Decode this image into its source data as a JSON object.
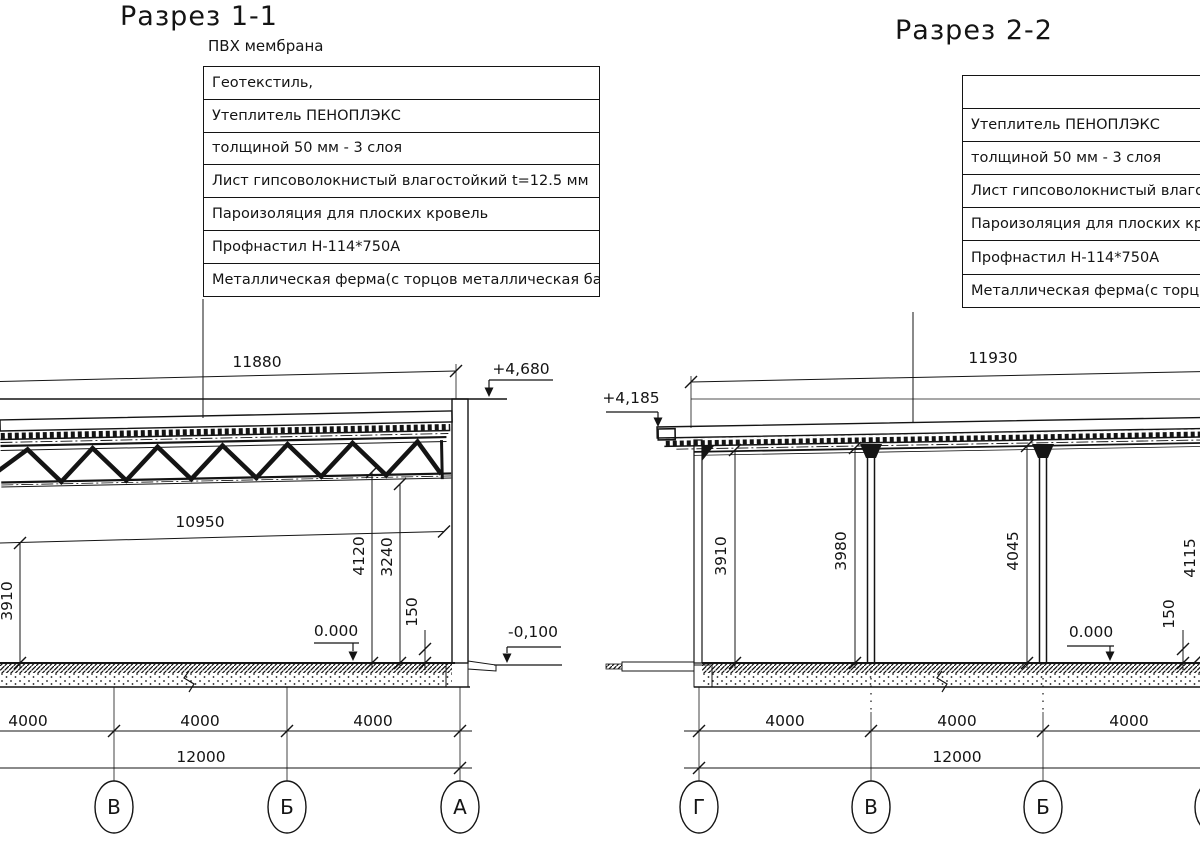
{
  "colors": {
    "ink": "#141414",
    "paper": "#ffffff"
  },
  "s1": {
    "title": "Разрез 1-1",
    "callout_top": "ПВХ мембрана",
    "callout_rows": [
      "Геотекстиль,",
      "Утеплитель ПЕНОПЛЭКС",
      "толщиной 50 мм - 3 слоя",
      "Лист гипсоволокнистый влагостойкий t=12.5 мм",
      "Пароизоляция для плоских кровель",
      "Профнастил Н-114*750А",
      "Металлическая ферма(с торцов металлическая балка )"
    ],
    "dims": {
      "span_top": "11880",
      "span_clear": "10950",
      "height_left": "3910",
      "height_truss": "4120",
      "height_clear": "3240",
      "slab_edge": "150",
      "bays": [
        "4000",
        "4000",
        "4000"
      ],
      "total": "12000"
    },
    "levels": {
      "top": "+4,680",
      "zero": "0.000",
      "ground": "-0,100"
    },
    "axes": [
      "В",
      "Б",
      "А"
    ]
  },
  "s2": {
    "title": "Разрез 2-2",
    "callout_rows": [
      "",
      "Утеплитель ПЕНОПЛЭКС",
      "толщиной 50 мм - 3 слоя",
      "Лист гипсоволокнистый влагостойкий t=12.5 мм",
      "Пароизоляция для плоских кровель",
      "Профнастил Н-114*750А",
      "Металлическая ферма(с торцов металлическая балка )"
    ],
    "dims": {
      "span_top": "11930",
      "height_1": "3910",
      "height_2": "3980",
      "height_3": "4045",
      "height_4": "4115",
      "slab_edge": "150",
      "bays": [
        "4000",
        "4000",
        "4000"
      ],
      "total": "12000"
    },
    "levels": {
      "top": "+4,185",
      "zero": "0.000"
    },
    "axes": [
      "Г",
      "В",
      "Б"
    ]
  }
}
